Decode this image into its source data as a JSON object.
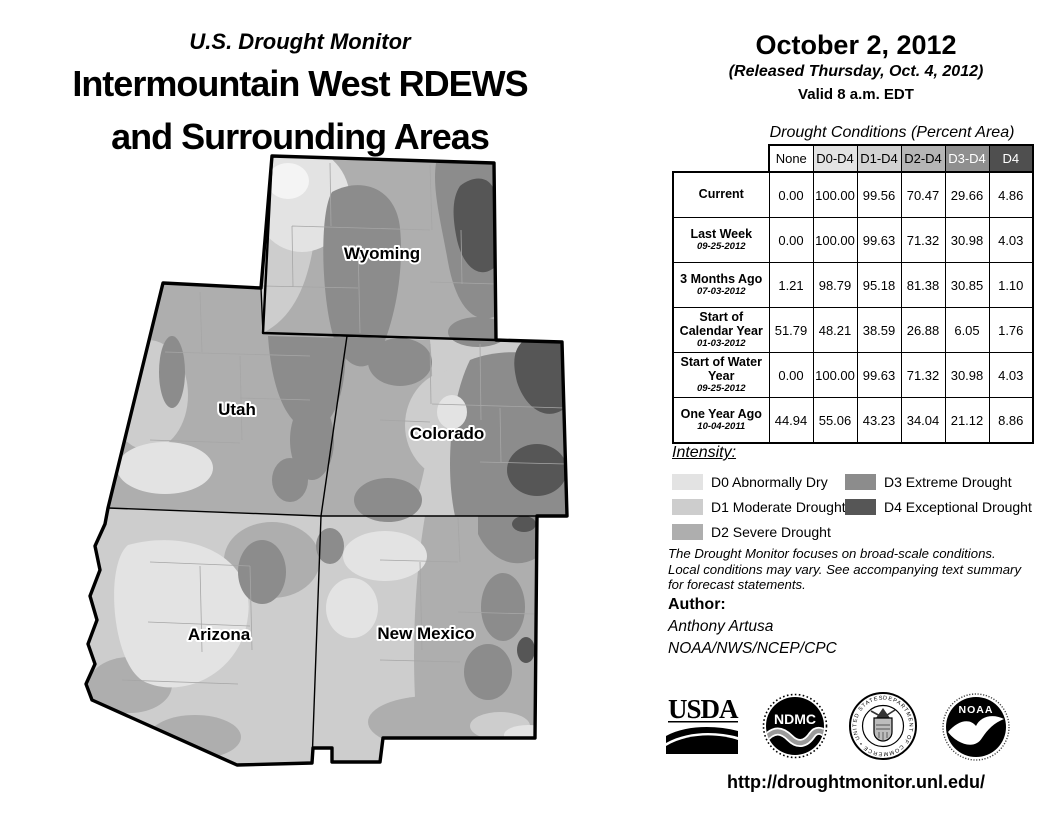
{
  "colors": {
    "none": "#ffffff",
    "d0": "#e3e3e3",
    "d1": "#cdcdcd",
    "d2": "#aeaeae",
    "d3": "#8c8c8c",
    "d4": "#565656",
    "d0_light": "#f4f4f4",
    "county_line": "#a6a6a6",
    "map_border": "#000000"
  },
  "header": {
    "monitor_title": "U.S. Drought Monitor",
    "region_title_line1": "Intermountain West RDEWS",
    "region_title_line2": "and Surrounding Areas"
  },
  "date_block": {
    "date": "October 2, 2012",
    "released": "(Released Thursday, Oct. 4, 2012)",
    "valid": "Valid 8 a.m. EDT"
  },
  "map": {
    "labels": {
      "wyoming": "Wyoming",
      "utah": "Utah",
      "colorado": "Colorado",
      "arizona": "Arizona",
      "new_mexico": "New Mexico"
    }
  },
  "table": {
    "caption": "Drought Conditions (Percent Area)",
    "columns": [
      "None",
      "D0-D4",
      "D1-D4",
      "D2-D4",
      "D3-D4",
      "D4"
    ],
    "header_bg": [
      "#ffffff",
      "#e3e3e3",
      "#d2d2d2",
      "#b5b5b5",
      "#8f8f8f",
      "#4f4f4f"
    ],
    "header_fg": [
      "#000000",
      "#000000",
      "#000000",
      "#000000",
      "#ffffff",
      "#ffffff"
    ],
    "rows": [
      {
        "label": "Current",
        "date": "",
        "values": [
          "0.00",
          "100.00",
          "99.56",
          "70.47",
          "29.66",
          "4.86"
        ]
      },
      {
        "label": "Last Week",
        "date": "09-25-2012",
        "values": [
          "0.00",
          "100.00",
          "99.63",
          "71.32",
          "30.98",
          "4.03"
        ]
      },
      {
        "label": "3 Months Ago",
        "date": "07-03-2012",
        "values": [
          "1.21",
          "98.79",
          "95.18",
          "81.38",
          "30.85",
          "1.10"
        ]
      },
      {
        "label": "Start of Calendar Year",
        "date": "01-03-2012",
        "values": [
          "51.79",
          "48.21",
          "38.59",
          "26.88",
          "6.05",
          "1.76"
        ]
      },
      {
        "label": "Start of Water Year",
        "date": "09-25-2012",
        "values": [
          "0.00",
          "100.00",
          "99.63",
          "71.32",
          "30.98",
          "4.03"
        ]
      },
      {
        "label": "One Year Ago",
        "date": "10-04-2011",
        "values": [
          "44.94",
          "55.06",
          "43.23",
          "34.04",
          "21.12",
          "8.86"
        ]
      }
    ]
  },
  "legend": {
    "title": "Intensity:",
    "items": [
      {
        "code": "D0",
        "label": "D0 Abnormally Dry",
        "color": "#e3e3e3"
      },
      {
        "code": "D1",
        "label": "D1 Moderate Drought",
        "color": "#cdcdcd"
      },
      {
        "code": "D2",
        "label": "D2 Severe Drought",
        "color": "#aeaeae"
      },
      {
        "code": "D3",
        "label": "D3 Extreme Drought",
        "color": "#8c8c8c"
      },
      {
        "code": "D4",
        "label": "D4 Exceptional Drought",
        "color": "#565656"
      }
    ]
  },
  "disclaimer": {
    "lines": [
      "The Drought Monitor focuses on broad-scale conditions.",
      "Local conditions may vary. See accompanying text summary",
      "for forecast statements."
    ]
  },
  "author": {
    "heading": "Author:",
    "name": "Anthony Artusa",
    "org": "NOAA/NWS/NCEP/CPC"
  },
  "logos": {
    "usda": "USDA",
    "ndmc": "NDMC",
    "noaa": "NOAA",
    "doc_ring": "DEPARTMENT OF COMMERCE • UNITED STATES OF AMERICA •"
  },
  "footer": {
    "url": "http://droughtmonitor.unl.edu/"
  }
}
